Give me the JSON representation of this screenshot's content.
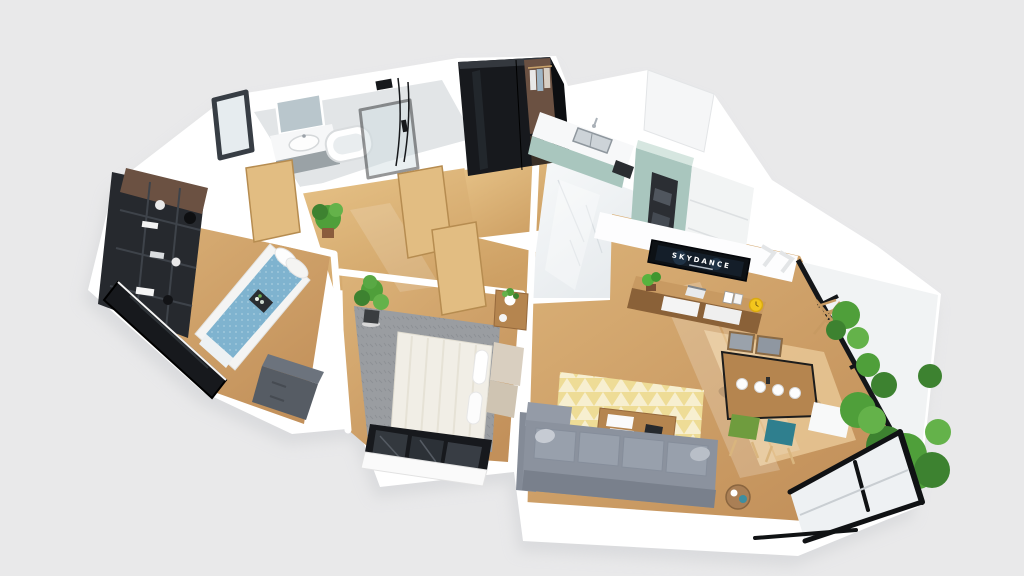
{
  "scene": {
    "description": "3D isometric floor plan render of an apartment viewed from above",
    "background_color": "#e9e9ea"
  },
  "palette": {
    "wall_white": "#ffffff",
    "slab_shadow": "#d0d2d5",
    "wood_floor": "#cda265",
    "wood_floor_light": "#e5c68d",
    "marble_floor": "#f0f2f4",
    "tile_floor": "#e2e5e7",
    "black_frame": "#17191d",
    "dark_walnut": "#6b5142",
    "mint_cabinet": "#a9c6be",
    "mint_cabinet_light": "#d6e6e0",
    "steel_sink": "#cdd3d8",
    "bed_blue": "#7fb3cf",
    "bed_linen": "#f1eee6",
    "rug_gray": "#9a9da1",
    "rug_yellow": "#eedc96",
    "sofa_gray": "#8b929e",
    "coffee_table_wood": "#b5854f",
    "sideboard_wood": "#c89a62",
    "dining_chair_green": "#6f9c3e",
    "dining_chair_teal": "#2f7f8e",
    "dining_chair_gray": "#9aa2ab",
    "plant_green": "#4f9f3a",
    "plant_green_dark": "#3d8230",
    "clock_yellow": "#f3c61d",
    "tv_black": "#0d1115"
  },
  "tv": {
    "screen_text": "SKYDANCE"
  },
  "rooms": [
    {
      "name": "bathroom",
      "items": [
        "vanity sink",
        "mirror",
        "bathtub",
        "glass shower",
        "dark framed window"
      ]
    },
    {
      "name": "entry hall",
      "items": [
        "black wardrobe",
        "open closet with clothes",
        "wooden doors"
      ]
    },
    {
      "name": "kitchen",
      "items": [
        "marble floor",
        "mint green cabinets",
        "double sink",
        "built-in oven column"
      ]
    },
    {
      "name": "second bedroom",
      "items": [
        "dark shelving unit",
        "bed with blue duvet",
        "gray dresser",
        "black framed window"
      ]
    },
    {
      "name": "master bedroom",
      "items": [
        "double bed with white linen",
        "gray shag rug",
        "potted plant",
        "nightstand",
        "black framed balcony door"
      ]
    },
    {
      "name": "living room",
      "items": [
        "wall tv",
        "wooden sideboard",
        "gray corner sofa",
        "coffee table with books",
        "patterned rug",
        "dining table with plates",
        "four dining chairs",
        "side table"
      ]
    },
    {
      "name": "balcony",
      "items": [
        "green plants",
        "wooden folding chair",
        "black framed glazing"
      ]
    }
  ]
}
